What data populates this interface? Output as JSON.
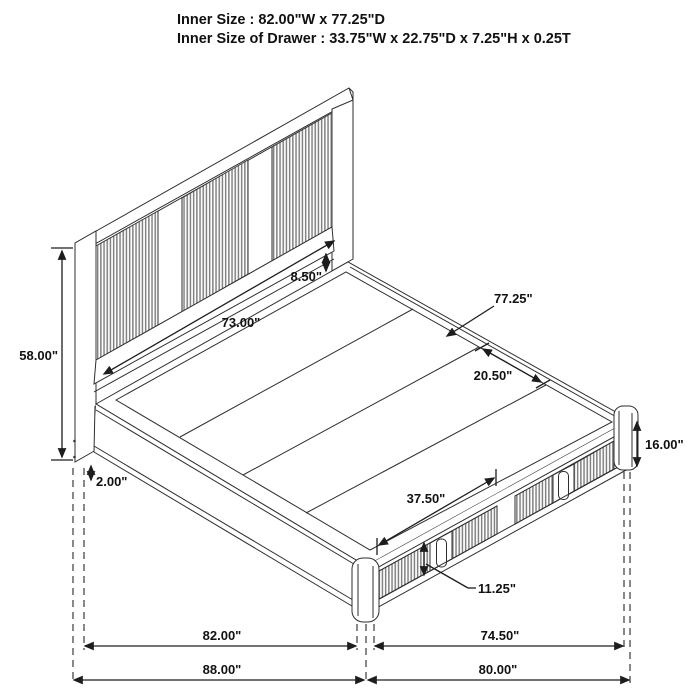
{
  "header": {
    "line1": "Inner Size : 82.00\"W x 77.25\"D",
    "line2": "Inner Size of Drawer : 33.75\"W x 22.75\"D x 7.25\"H x 0.25T"
  },
  "dimensions": {
    "headboard_height": "58.00\"",
    "floor_gap": "2.00\"",
    "headboard_inner_width": "73.00\"",
    "deck_to_headboard_gap": "8.50\"",
    "platform_depth": "77.25\"",
    "slat_section_depth": "20.50\"",
    "frame_height": "16.00\"",
    "drawer_front_width": "37.50\"",
    "drawer_front_height": "11.25\"",
    "bottom_inner_left": "82.00\"",
    "bottom_inner_right": "74.50\"",
    "bottom_overall_left": "88.00\"",
    "bottom_overall_right": "80.00\""
  },
  "colors": {
    "line": "#2e2e2e",
    "dimension": "#1d1d1d",
    "rib": "#828282",
    "background": "#ffffff"
  }
}
